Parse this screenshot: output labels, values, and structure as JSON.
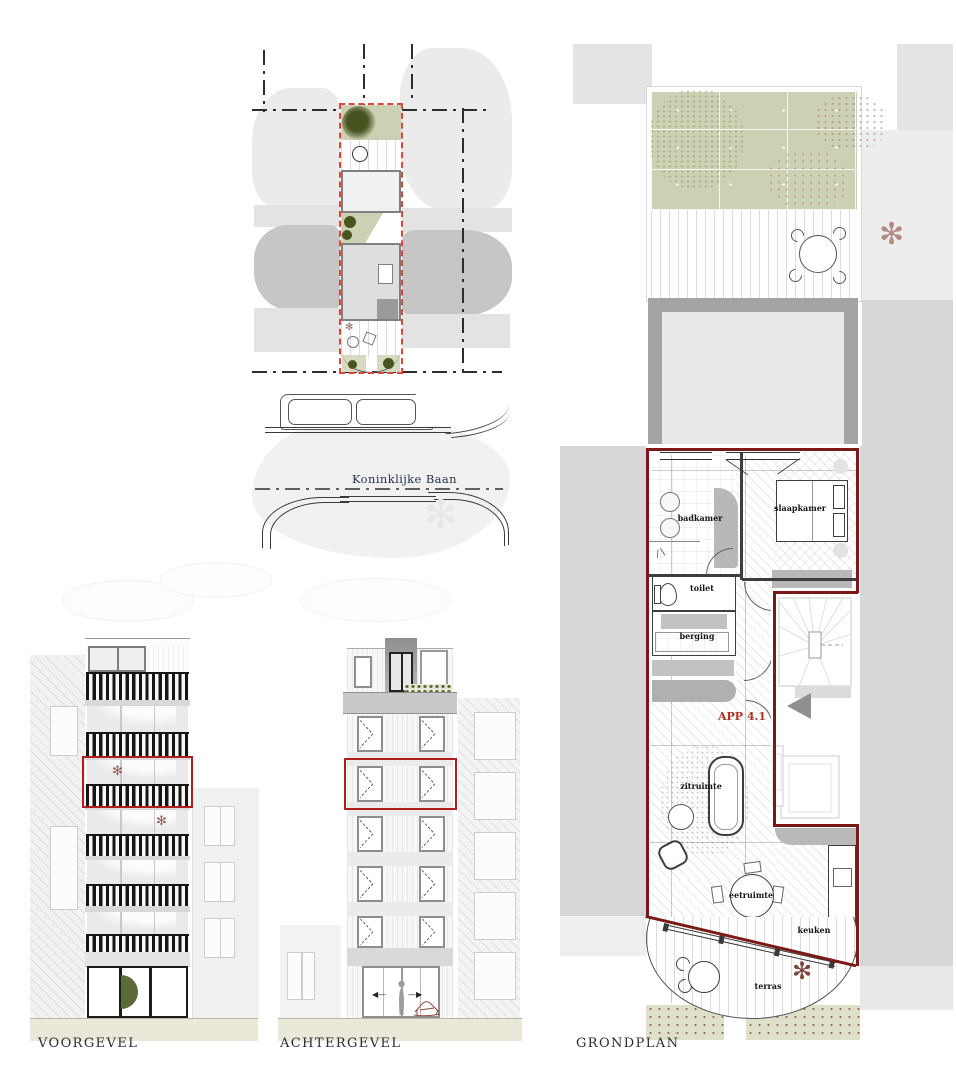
{
  "drawing": {
    "captions": {
      "voorgevel": "VOORGEVEL",
      "achtergevel": "ACHTERGEVEL",
      "grondplan": "GRONDPLAN"
    },
    "site_plan": {
      "street_label": "Koninklijke Baan"
    },
    "floorplan": {
      "apartment_label": "APP 4.1",
      "rooms": {
        "badkamer": "badkamer",
        "slaapkamer": "slaapkamer",
        "toilet": "toilet",
        "berging": "berging",
        "zitruimte": "zitruimte",
        "eetruimte": "eetruimte",
        "keuken": "keuken",
        "terras": "terras"
      }
    },
    "colors": {
      "parcel_dash_red": "#e0453c",
      "unit_outline_red": "#7a1916",
      "highlight_red": "#b11d1d",
      "apartment_label_red": "#a93226",
      "garden_green": "#ccd1b4",
      "tree_olive": "#4b5a24",
      "street_label_navy": "#26334e",
      "ground_beige": "#eae8d9"
    }
  }
}
